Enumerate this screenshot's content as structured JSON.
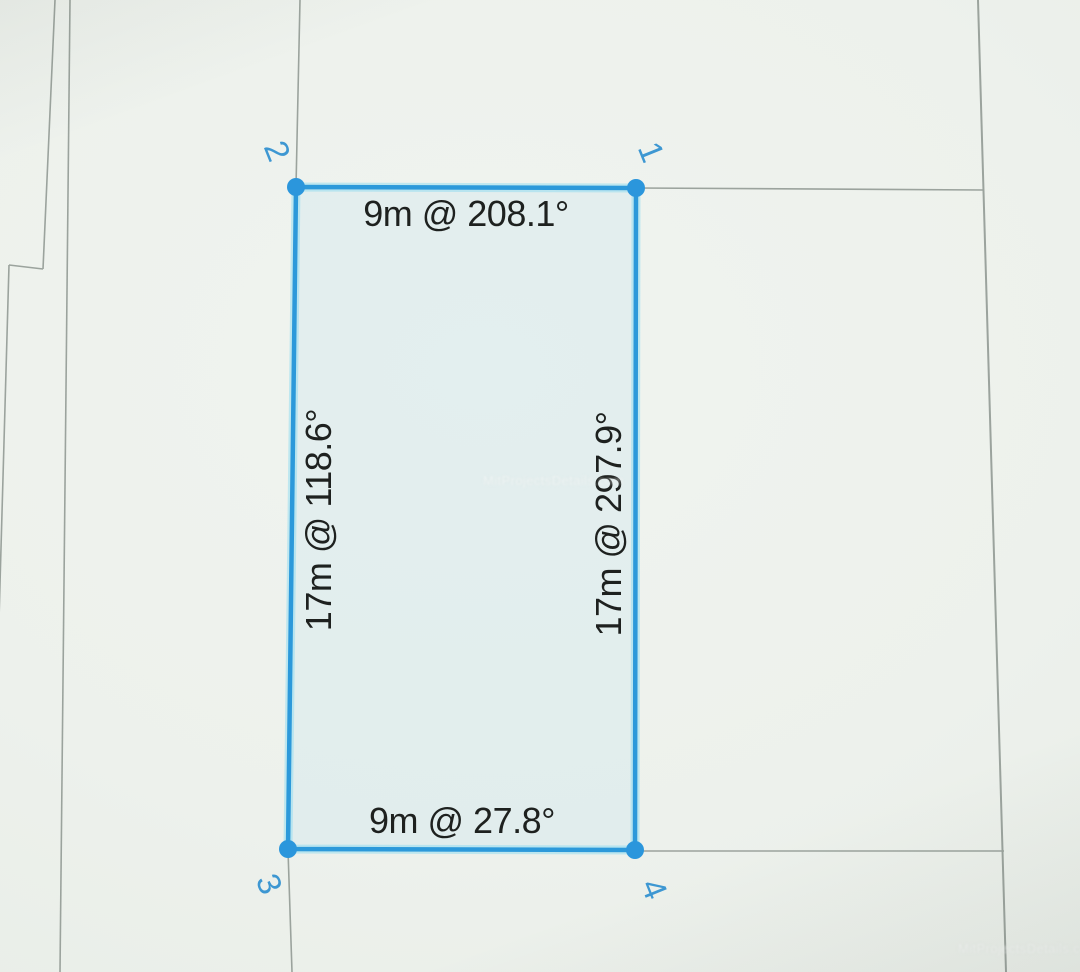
{
  "view": {
    "description": "GPS land survey measurement map view with a selected parcel polygon",
    "colors": {
      "accent_blue": "#2c99da",
      "vertex_handle_blue": "#2b96dc",
      "corner_label_blue": "#3d97d2",
      "boundary_line_gray": "#9ba39d",
      "background": "#edf1ec",
      "edge_label_text": "#1e211f"
    }
  },
  "parcel": {
    "corners": [
      {
        "label": "1",
        "position": "top-right"
      },
      {
        "label": "2",
        "position": "top-left"
      },
      {
        "label": "3",
        "position": "bottom-left"
      },
      {
        "label": "4",
        "position": "bottom-right"
      }
    ],
    "edges": [
      {
        "side": "top",
        "from_corner": "2",
        "to_corner": "1",
        "length": "9m",
        "bearing": "208.1°",
        "label": "9m @ 208.1°"
      },
      {
        "side": "left",
        "from_corner": "3",
        "to_corner": "2",
        "length": "17m",
        "bearing": "118.6°",
        "label": "17m @ 118.6°"
      },
      {
        "side": "right",
        "from_corner": "1",
        "to_corner": "4",
        "length": "17m",
        "bearing": "297.9°",
        "label": "17m @ 297.9°"
      },
      {
        "side": "bottom",
        "from_corner": "3",
        "to_corner": "4",
        "length": "9m",
        "bearing": "27.8°",
        "label": "9m @ 27.8°"
      }
    ]
  },
  "watermarks": {
    "center": "MitProjectsDetails.com",
    "bottom_right": "MitProjectsDetails.com"
  }
}
